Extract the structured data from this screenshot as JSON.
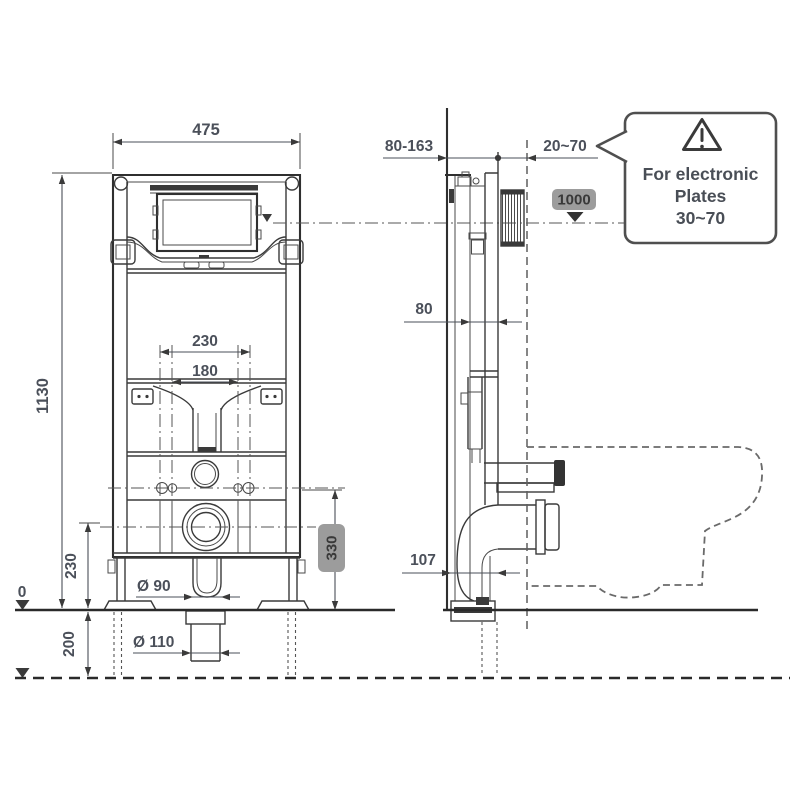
{
  "front": {
    "width": "475",
    "height": "1130",
    "bolt_spacing_outer": "230",
    "bolt_spacing_inner": "180",
    "bolt_height": "330",
    "outlet_height": "230",
    "below_floor": "200",
    "floor_level": "0",
    "outlet_diameter": "Ø 90",
    "drain_diameter": "Ø 110"
  },
  "side": {
    "depth_range": "80-163",
    "wall_range": "20~70",
    "plate_height": "1000",
    "cistern_depth": "80",
    "foot_offset": "107"
  },
  "callout": {
    "line1": "For electronic",
    "line2": "Plates",
    "line3": "30~70"
  },
  "colors": {
    "line": "#3a3a3a",
    "dim_text": "#4b505a",
    "badge_bg": "#9c9c9c",
    "badge_text": "#393939",
    "dashed": "#666666",
    "background": "#ffffff"
  }
}
